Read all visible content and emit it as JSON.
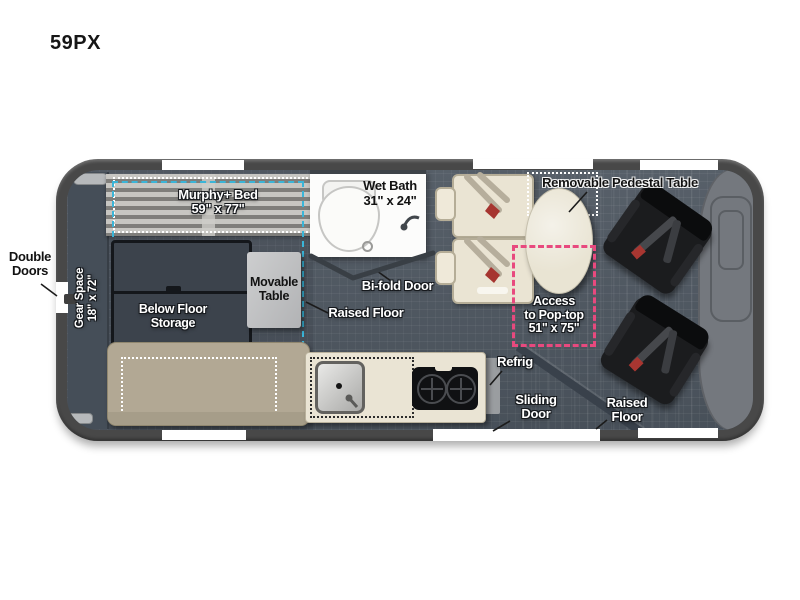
{
  "page": {
    "title": "59PX"
  },
  "labels": {
    "double_doors": [
      "Double",
      "Doors"
    ],
    "gear_space": [
      "Gear Space",
      "18\" x 72\""
    ],
    "murphy_bed": [
      "Murphy+ Bed",
      "59\" x 77\""
    ],
    "wet_bath": [
      "Wet Bath",
      "31\" x 24\""
    ],
    "removable_pedestal_table": "Removable Pedestal Table",
    "movable_table": [
      "Movable",
      "Table"
    ],
    "below_floor_storage": [
      "Below Floor",
      "Storage"
    ],
    "bifold_door": "Bi-fold Door",
    "raised_floor_mid": "Raised Floor",
    "access_pop_top": [
      "Access",
      "to Pop-top",
      "51\" x 75\""
    ],
    "refrig": "Refrig",
    "sliding_door": [
      "Sliding",
      "Door"
    ],
    "raised_floor_front": [
      "Raised",
      "Floor"
    ]
  },
  "colors": {
    "body_gray": "#484848",
    "floor_slate": "#4e5761",
    "cab_gray": "#74787e",
    "accent_cyan": "#3ab5d8",
    "accent_pink": "#e8497e",
    "sofa_tan": "#b2a894",
    "counter_cream": "#eae4d4",
    "chair_black": "#1b1c1e"
  }
}
